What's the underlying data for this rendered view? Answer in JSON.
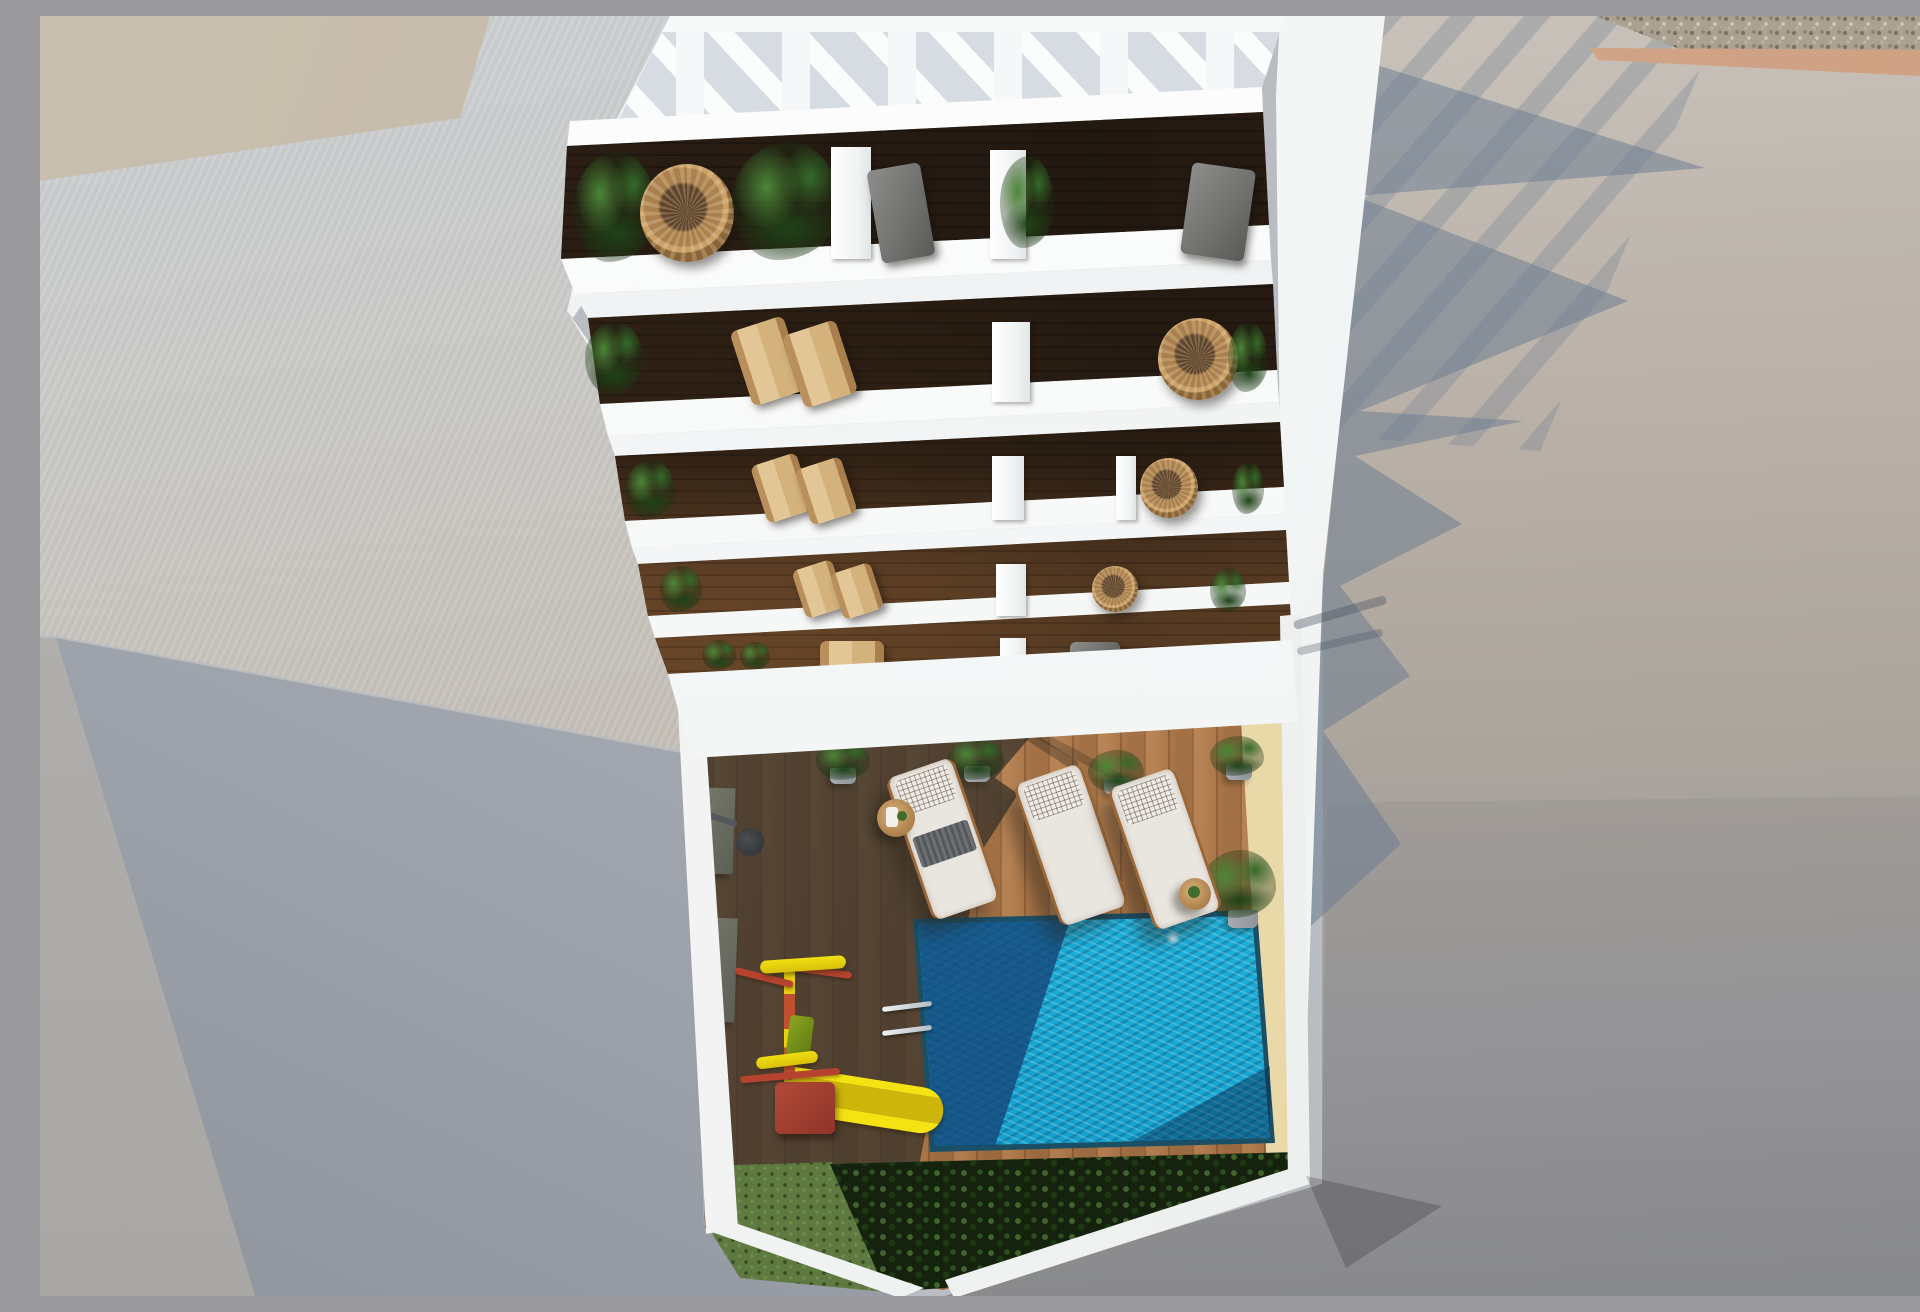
{
  "scene": {
    "type": "architectural-render",
    "view": "top-down-aerial",
    "aria_label": "Top-down 3D architectural rendering of a white apartment building with a slatted rooftop pergola, five floors of balconies furnished with plants, wicker and wooden lounge chairs, and a ground-floor courtyard containing a swimming pool with ladder, three cushioned sun loungers, side tables, potted plants, a children's playground with a yellow slide, dark and sunlit wooden decking, lawn and hedge planting, surrounded by neighboring flat rooftops and shadowed walls.",
    "caption": "Aerial view of apartment building with pool courtyard",
    "objects": [
      "rooftop pergola with slats",
      "balcony floors with plants and chairs",
      "white parapet bands",
      "courtyard wooden deck in sun and shade",
      "swimming pool with shadowed and sunlit water",
      "pool ladder",
      "three sun loungers with white cushions",
      "round side tables",
      "potted plants",
      "children's playground with yellow slide",
      "hedge bushes and lawn strip",
      "neighboring rooftops and gravel strip",
      "cast building shadows"
    ]
  },
  "palette": {
    "building-white": "#f7f8f8",
    "balcony-wood": "#4d3523",
    "pergola-floor": "#d7dce2",
    "roof-beige": "#c9bfae",
    "roof-greige": "#c2bbb1",
    "wall-blue-gray": "#a9aeb6",
    "right-plane-gray": "#9b9a9c",
    "shadow-blue": "#68798f",
    "pebble-base": "#aba192",
    "tan-band": "#d9ae8e",
    "deck-sun": "#b07a4c",
    "deck-shade": "#4e4a43",
    "pool-turquoise": "#12a0cc",
    "pool-navy": "#144676",
    "lounger-white": "#e9e5df",
    "plant-green": "#356a2a",
    "bush-dark": "#15230e",
    "grass-green": "#5e7a40",
    "slide-yellow": "#e8d311",
    "play-red": "#b5432f",
    "table-wood": "#c79a63",
    "ladder-chrome": "#d5dbdf"
  }
}
